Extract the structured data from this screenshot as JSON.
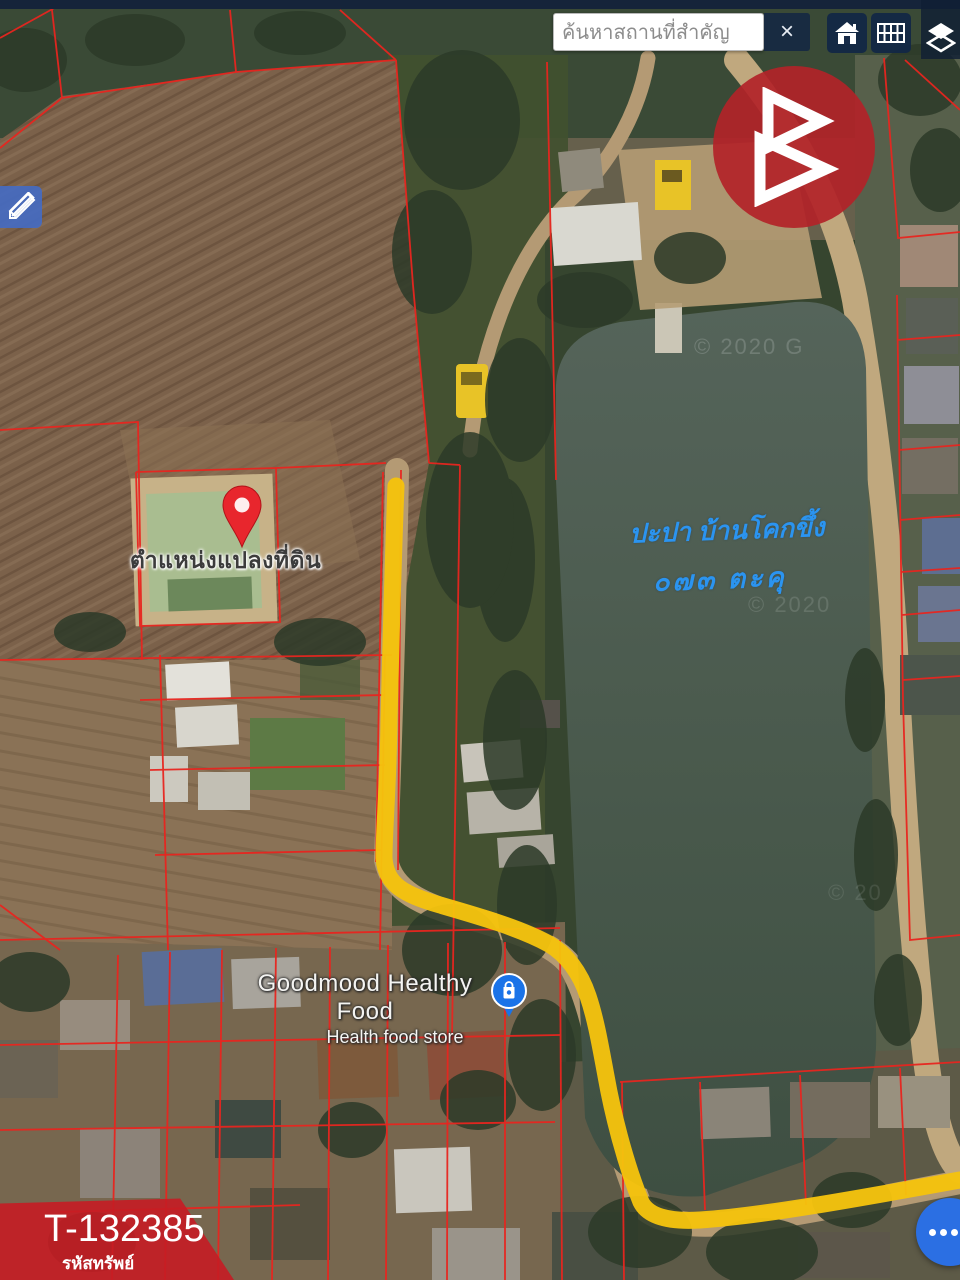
{
  "topbar": {
    "search_placeholder": "ค้นหาสถานที่สำคัญ",
    "close_label": "×",
    "icons": {
      "home": "home-icon",
      "grid": "grid-table-icon",
      "layers": "layers-icon"
    }
  },
  "tools": {
    "edit": "pencil-ruler-icon"
  },
  "annotations": {
    "marker_label": "ตำแหน่งแปลงที่ดิน",
    "pond_note_line1": "ปะปา บ้านโคกขึ้ง",
    "pond_note_line2": "๐๗๓ ตะคุ"
  },
  "poi": {
    "name": "Goodmood Healthy Food",
    "category": "Health food store",
    "icon": "shopping-bag-pin-icon"
  },
  "watermarks": {
    "w1": "© 2020 G",
    "w2": "© 2020",
    "w3": "© 20"
  },
  "property": {
    "code": "T-132385",
    "label": "รหัสทรัพย์"
  },
  "colors": {
    "route_highlight": "#f5c30e",
    "parcel_line": "#e8251f",
    "banner_red": "#c51c23",
    "fab_blue": "#2b6fe3",
    "note_blue": "#2b94f0",
    "pin_red": "#e8262d",
    "navbar_navy": "#15243a"
  }
}
